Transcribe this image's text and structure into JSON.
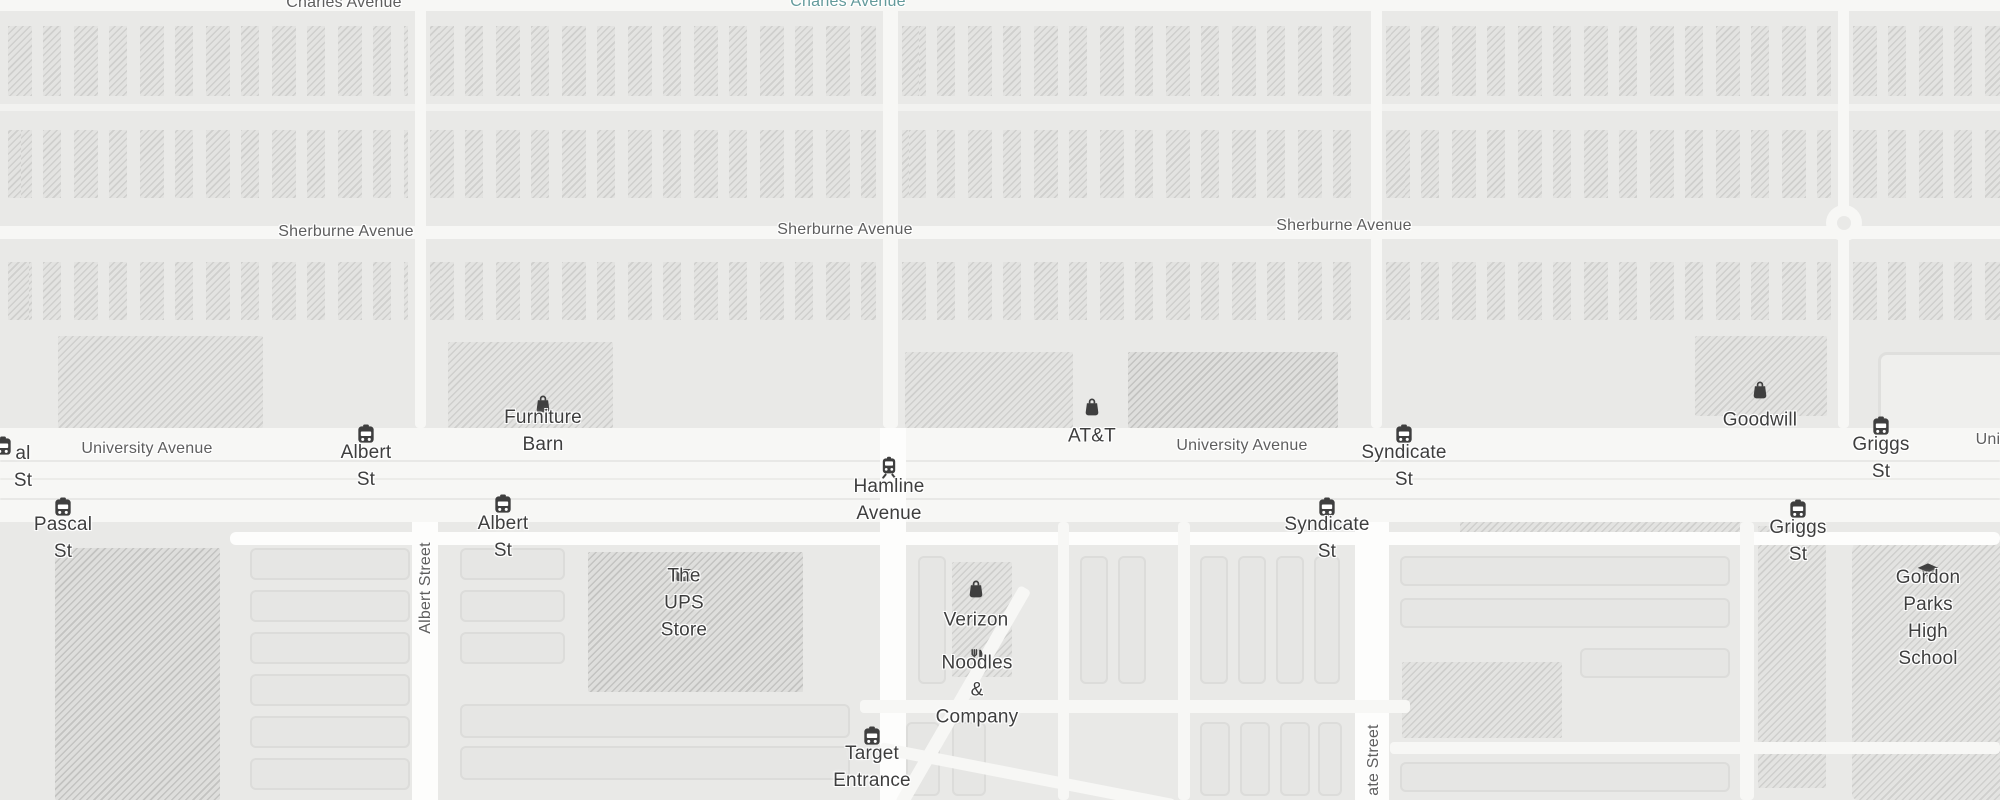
{
  "map": {
    "title": "University Avenue corridor street map",
    "palette": {
      "background": "#e9e9e7",
      "road": "#fdfdfc",
      "road_minor": "#f7f7f5",
      "building_fill": "#e3e3e1",
      "building_hatch": "#cfcfcd",
      "parking_fill": "#e6e6e4",
      "street_label": "#5e5e5e",
      "poi_label": "#3e3e3e",
      "transit_label": "#639a9b",
      "icon": "#3f3f3f"
    },
    "street_labels": [
      {
        "text": "Charles Avenue",
        "x": 344,
        "y": 3,
        "kind": "street"
      },
      {
        "text": "Charles Avenue",
        "x": 848,
        "y": 2,
        "kind": "transit"
      },
      {
        "text": "Sherburne Avenue",
        "x": 346,
        "y": 232,
        "kind": "street"
      },
      {
        "text": "Sherburne Avenue",
        "x": 845,
        "y": 230,
        "kind": "street"
      },
      {
        "text": "Sherburne Avenue",
        "x": 1344,
        "y": 226,
        "kind": "street"
      },
      {
        "text": "University Avenue",
        "x": 147,
        "y": 449,
        "kind": "street"
      },
      {
        "text": "University Avenue",
        "x": 1242,
        "y": 446,
        "kind": "street"
      },
      {
        "text": "Univ",
        "x": 1992,
        "y": 440,
        "kind": "street"
      },
      {
        "text": "Albert Street",
        "x": 426,
        "y": 588,
        "kind": "street",
        "rotate": true
      },
      {
        "text": "ate Street",
        "x": 1374,
        "y": 760,
        "kind": "street",
        "rotate": true
      }
    ],
    "markers": [
      {
        "icon": "bus-icon",
        "label": "al St",
        "x": 23,
        "icon_dx": -20,
        "icon_y": 447,
        "label_y": 467
      },
      {
        "icon": "bus-icon",
        "label": "Albert St",
        "x": 366,
        "icon_y": 435,
        "label_y": 466
      },
      {
        "icon": "bus-icon",
        "label": "Syndicate St",
        "x": 1404,
        "icon_y": 435,
        "label_y": 466
      },
      {
        "icon": "bus-icon",
        "label": "Griggs St",
        "x": 1881,
        "icon_y": 427,
        "label_y": 458
      },
      {
        "icon": "bus-icon",
        "label": "Pascal St",
        "x": 63,
        "icon_y": 508,
        "label_y": 538
      },
      {
        "icon": "bus-icon",
        "label": "Albert St",
        "x": 503,
        "icon_y": 505,
        "label_y": 537
      },
      {
        "icon": "bus-icon",
        "label": "Syndicate St",
        "x": 1327,
        "icon_y": 508,
        "label_y": 538
      },
      {
        "icon": "bus-icon",
        "label": "Griggs St",
        "x": 1798,
        "icon_y": 510,
        "label_y": 541
      },
      {
        "icon": "bus-icon",
        "label": "Target Entrance",
        "x": 872,
        "icon_y": 737,
        "label_y": 767
      },
      {
        "icon": "rail-icon",
        "label": "Hamline Avenue",
        "x": 889,
        "icon_y": 468,
        "label_y": 500
      },
      {
        "icon": "shopping-bag-icon",
        "label": "Furniture Barn",
        "x": 543,
        "icon_y": 404,
        "label_y": 431
      },
      {
        "icon": "shopping-bag-icon",
        "label": "AT&T",
        "x": 1092,
        "icon_y": 407,
        "label_y": 436
      },
      {
        "icon": "shopping-bag-icon",
        "label": "Goodwill",
        "x": 1760,
        "icon_y": 390,
        "label_y": 420
      },
      {
        "icon": "shopping-bag-icon",
        "label": "Verizon",
        "x": 976,
        "icon_y": 589,
        "label_y": 620
      },
      {
        "icon": "mail-icon",
        "label": "The UPS Store",
        "x": 684,
        "icon_y": 575,
        "label_y": 603
      },
      {
        "icon": "restaurant-icon",
        "label": "Noodles & Company",
        "x": 977,
        "icon_y": 659,
        "label_y": 690
      },
      {
        "icon": "school-icon",
        "label": "Gordon Parks\nHigh School",
        "x": 1928,
        "icon_y": 572,
        "label_y": 618
      }
    ]
  }
}
